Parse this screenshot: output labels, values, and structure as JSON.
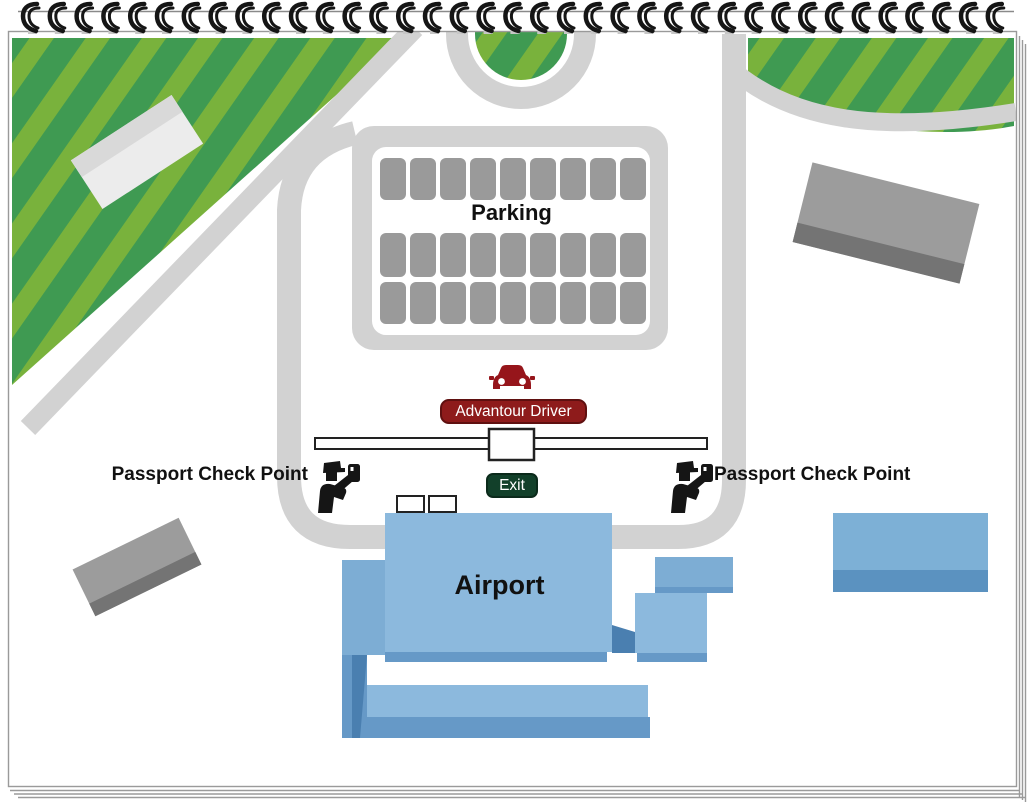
{
  "map": {
    "labels": {
      "parking": "Parking",
      "driver_pickup": "Advantour Driver",
      "exit": "Exit",
      "passport_check_left": "Passport Check Point",
      "passport_check_right": "Passport Check Point",
      "airport": "Airport"
    },
    "parking_lot": {
      "rows": 3,
      "cols": 9
    },
    "binding": {
      "rings": 37
    },
    "colors": {
      "page_border": "#9a9a9a",
      "road": "#d2d2d2",
      "grass": "#3f9a52",
      "grass_stripe": "#79b23c",
      "parking_spot": "#9a9a9a",
      "spot_field": "#ffffff",
      "driver_badge": "#8e1b1b",
      "driver_badge_border": "#5f1010",
      "exit_badge": "#12402a",
      "car_red": "#96151b",
      "icon_black": "#151515",
      "text_dark": "#111111",
      "badge_text": "#ffffff",
      "airport_blue": "#8cb9dd",
      "airport_blue_mid": "#6699c7",
      "airport_blue_deep": "#4a7fb0",
      "airport_blue_wing": "#7dadd4",
      "blue_building_top": "#7db0d6",
      "blue_building_bottom": "#5b92c0",
      "gray_building": "#9c9c9c",
      "gray_building_dark": "#747474",
      "white_building": "#ececec",
      "white_building_shade": "#d9d9d9"
    }
  }
}
